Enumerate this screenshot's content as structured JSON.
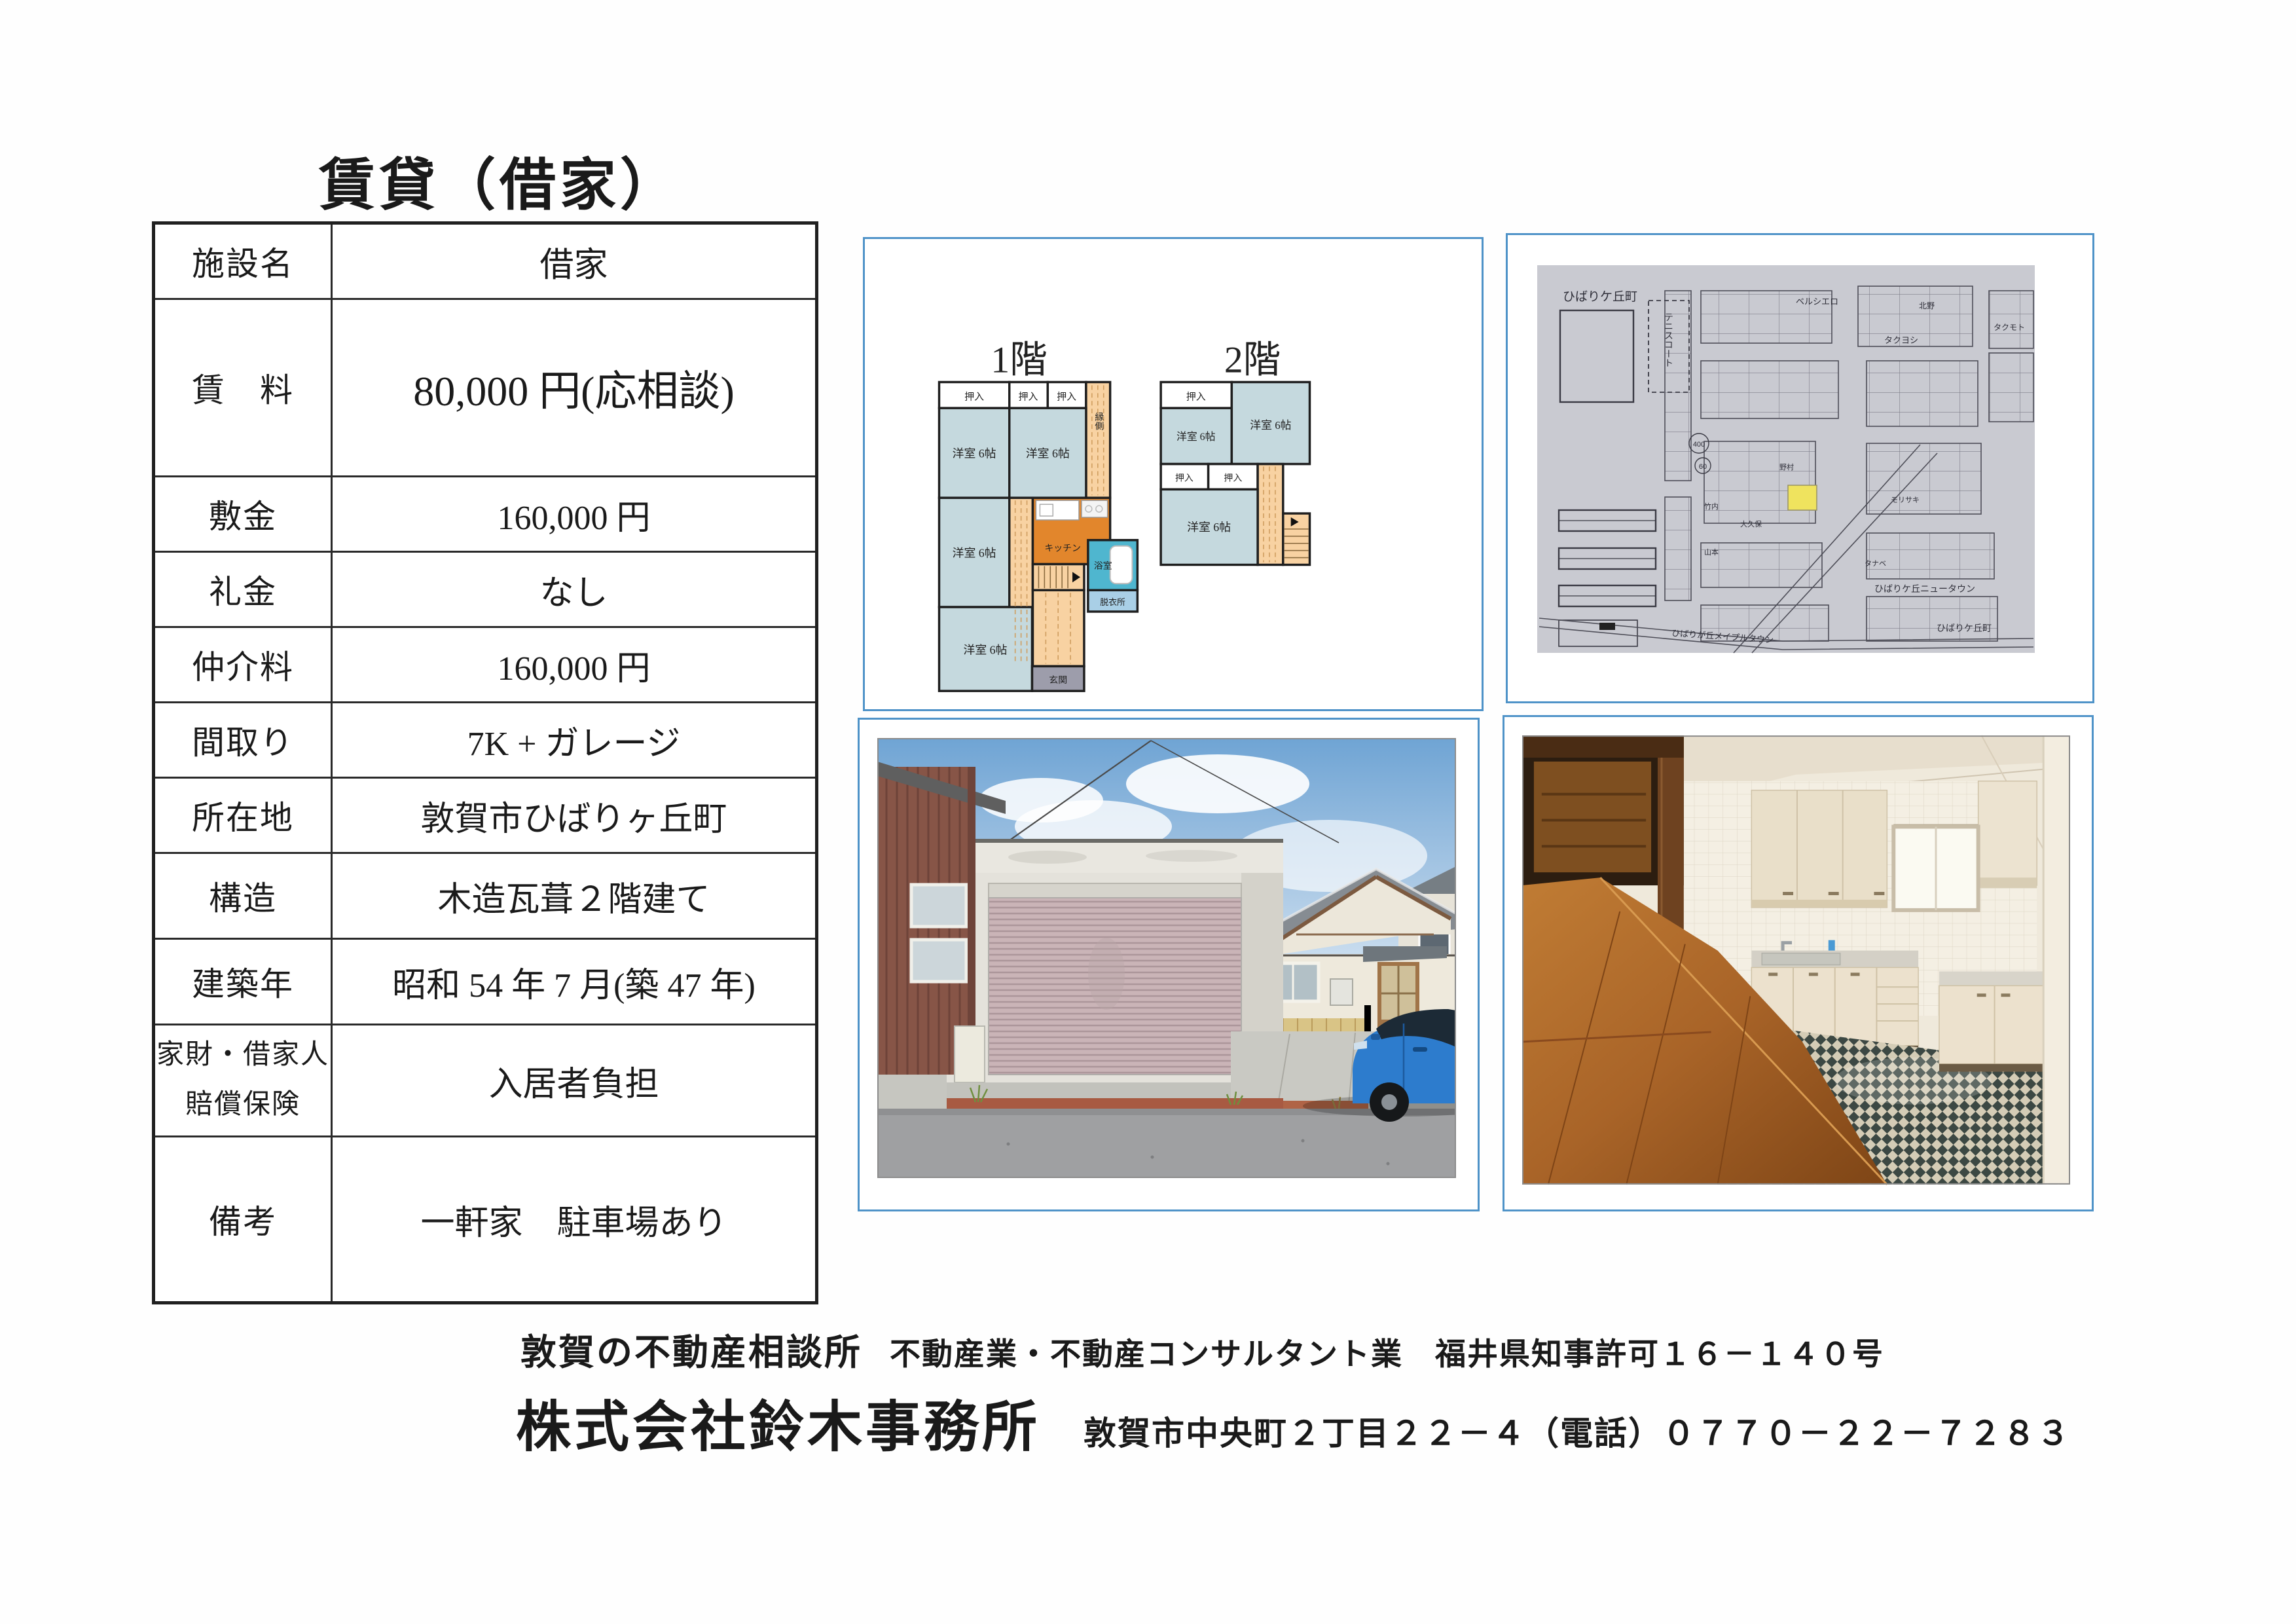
{
  "page": {
    "title": "賃貸（借家）"
  },
  "table": {
    "rows": [
      {
        "label": "施設名",
        "value": "借家"
      },
      {
        "label": "賃　料",
        "value": "80,000 円(応相談)"
      },
      {
        "label": "敷金",
        "value": "160,000 円"
      },
      {
        "label": "礼金",
        "value": "なし"
      },
      {
        "label": "仲介料",
        "value": "160,000 円"
      },
      {
        "label": "間取り",
        "value": "7K + ガレージ"
      },
      {
        "label": "所在地",
        "value": "敦賀市ひばりヶ丘町"
      },
      {
        "label": "構造",
        "value": "木造瓦葺２階建て"
      },
      {
        "label": "建築年",
        "value": "昭和 54 年 7 月(築 47 年)"
      },
      {
        "label1": "家財・借家人",
        "label2": "賠償保険",
        "value": "入居者負担"
      },
      {
        "label": "備考",
        "value": "一軒家　駐車場あり"
      }
    ]
  },
  "floorplan": {
    "floor1_label": "1階",
    "floor2_label": "2階",
    "labels": {
      "room6": "洋室 6帖",
      "closet": "押入",
      "engawa": "縁側",
      "kitchen": "キッチン",
      "bath": "浴室",
      "dressing": "脱衣所",
      "entrance": "玄関"
    }
  },
  "map": {
    "labels": {
      "town_tl": "ひばりケ丘町",
      "tennis": "テニスコート",
      "bersiero": "ベルシエロ",
      "takuyoshi": "タクヨシ",
      "kitano": "北野",
      "takumoto": "タクモト",
      "nomura": "野村",
      "takeuchi": "竹内",
      "okubo": "大久保",
      "yamamoto": "山本",
      "morisaki": "モリサキ",
      "tanabe": "タナベ",
      "newtown": "ひばりケ丘ニュータウン",
      "mapletown": "ひばりが丘メイプルタウン",
      "town_br": "ひばりケ丘町",
      "route1": "400",
      "route2": "60"
    }
  },
  "footer": {
    "line1_strong": "敦賀の不動産相談所",
    "line1_rest": "不動産業・不動産コンサルタント業　福井県知事許可１６－１４０号",
    "company": "株式会社鈴木事務所",
    "address": "敦賀市中央町２丁目２２－４（電話）０７７０－２２－７２８３"
  },
  "colors": {
    "panel-border": "#4f93c8",
    "wall": "#1f1f1f",
    "room": "#c5d9de",
    "hall": "#f8d2a2",
    "kitchen": "#e2862c",
    "bath": "#4fb6cf",
    "dressing": "#a9cfe6",
    "entrance": "#9d9dab",
    "map-paper": "#c9cad1",
    "map-ink": "#4e4e58",
    "highlight": "#efe35e"
  }
}
